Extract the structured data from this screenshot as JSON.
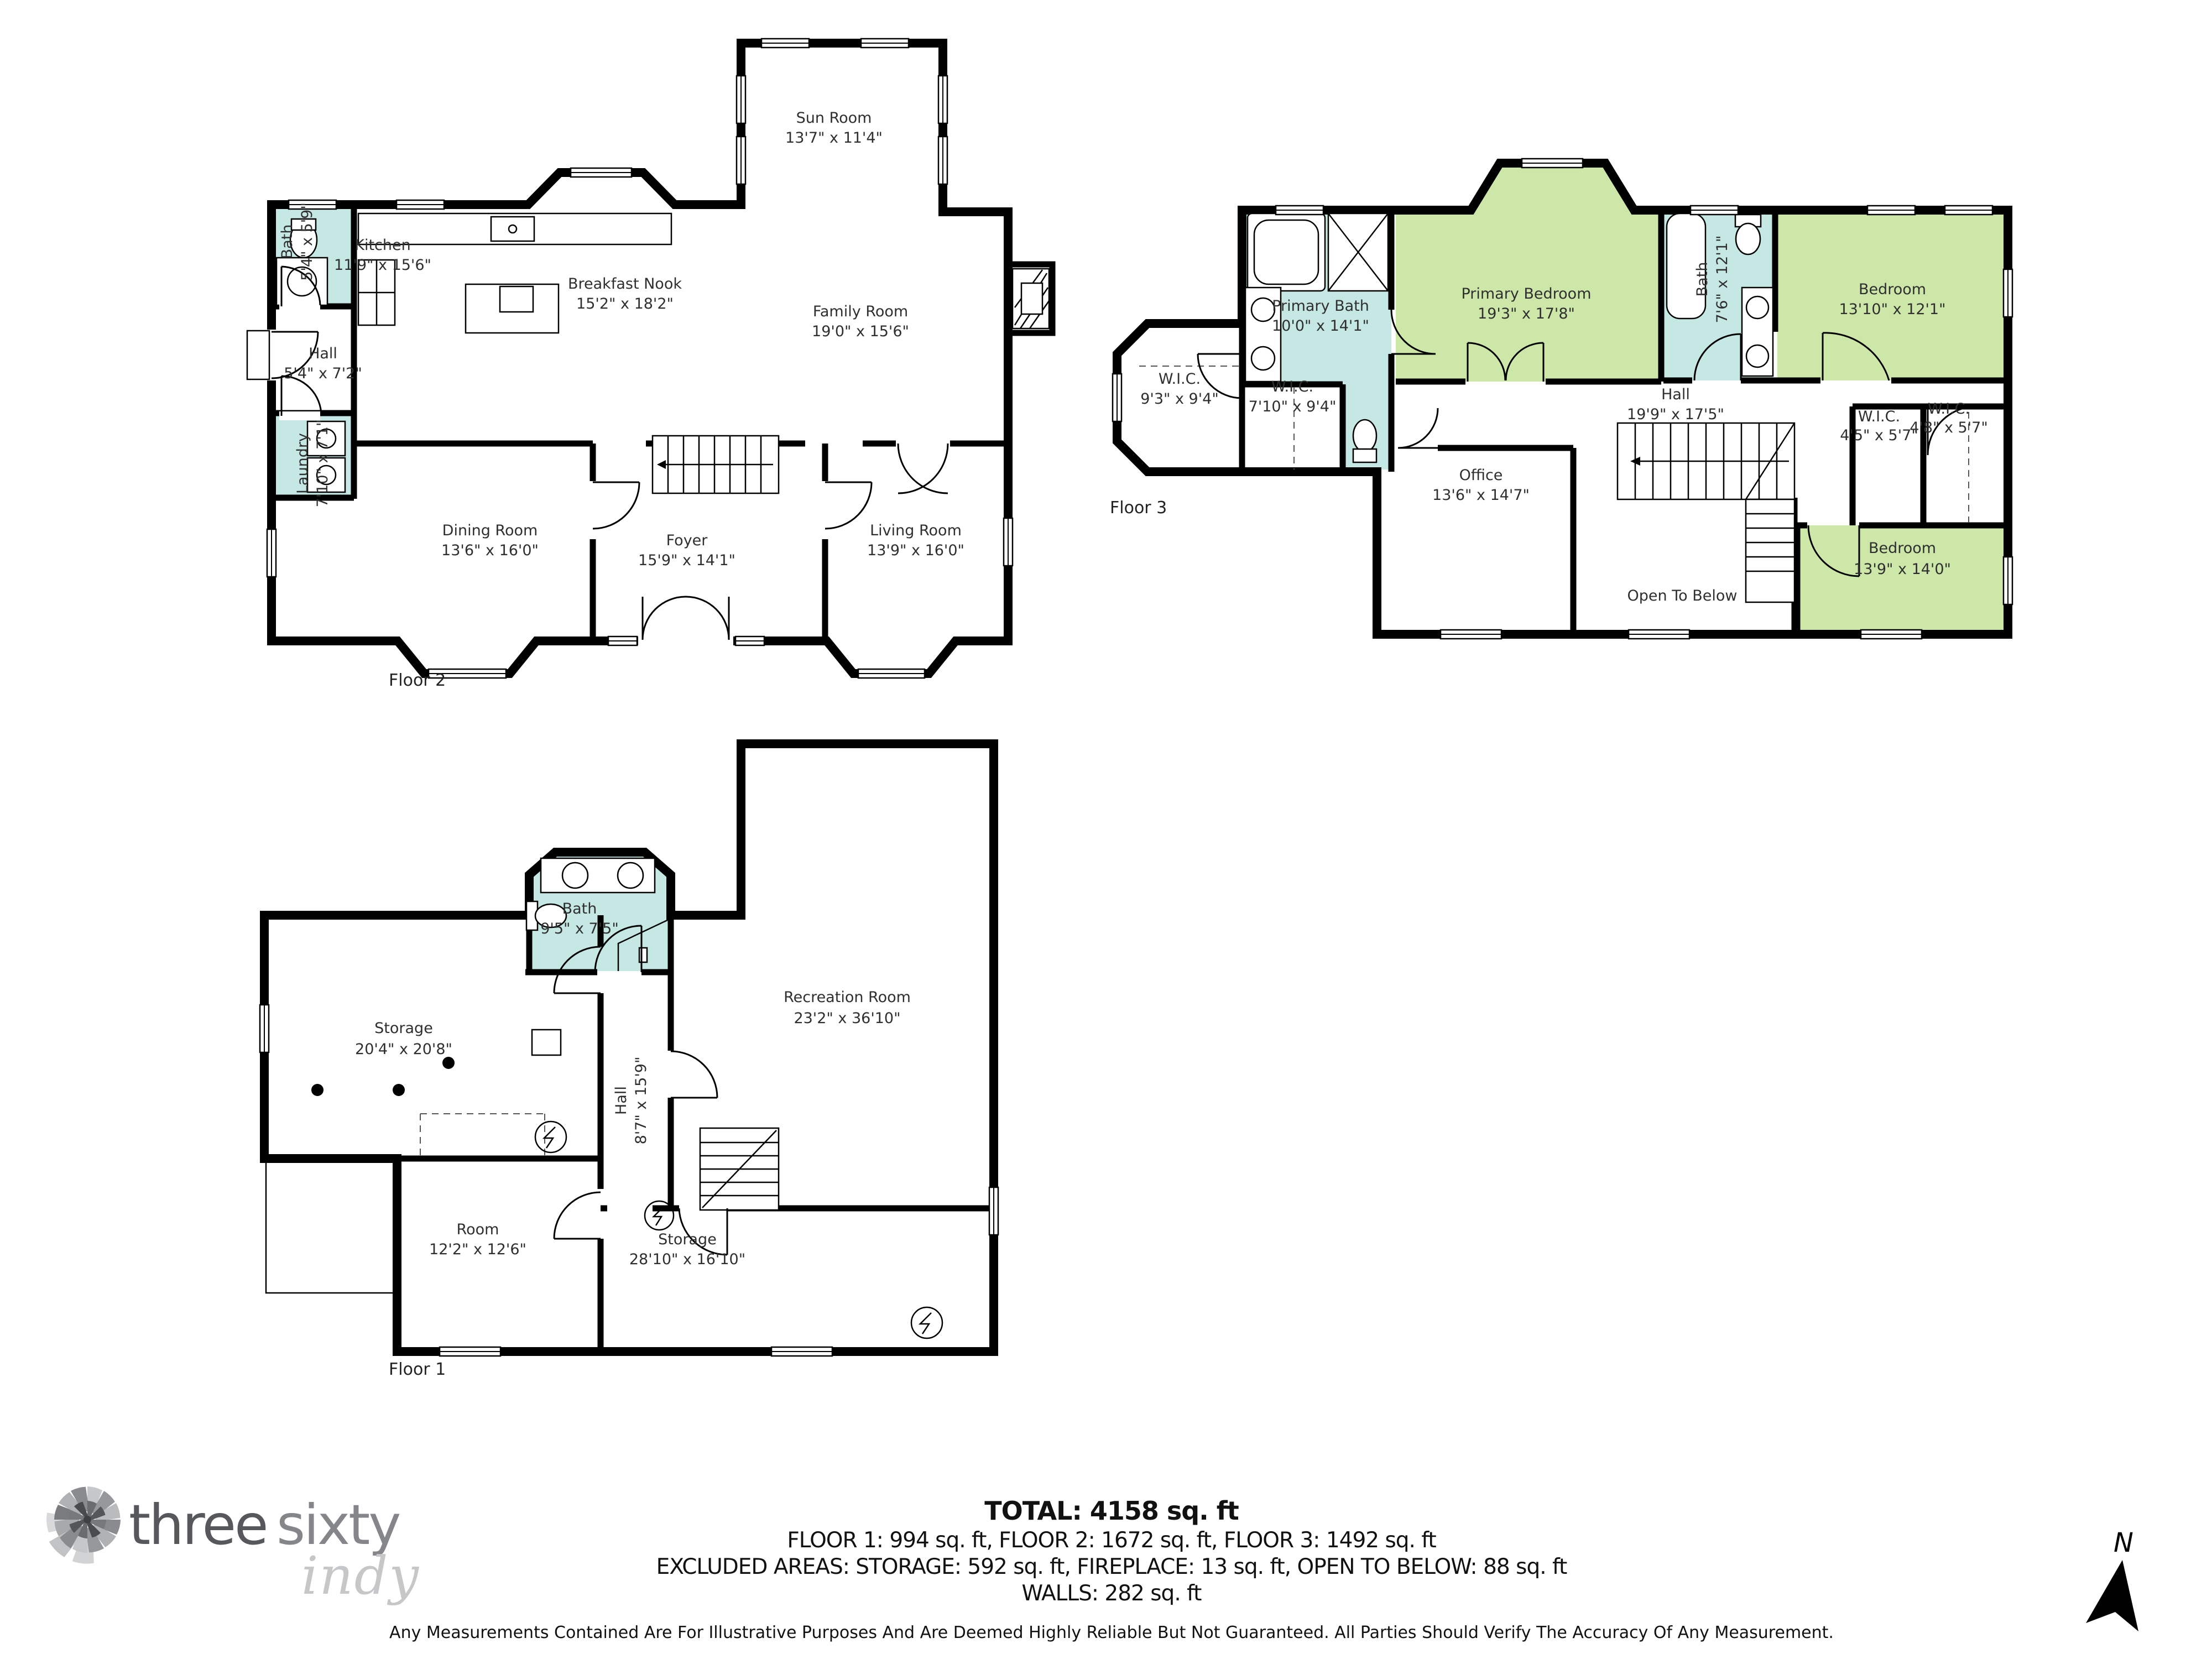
{
  "colors": {
    "bath": "#c5e8e4",
    "bedroom": "#cde7a8",
    "wall": "#000000",
    "label": "#2f2f2f",
    "logo_dark": "#57585c",
    "logo_mid": "#85868a",
    "logo_light": "#c6c7c9"
  },
  "floors": [
    {
      "label": "Floor 2",
      "rooms": [
        {
          "name": "Bath",
          "dims": "5'4\" x 5'9\""
        },
        {
          "name": "Kitchen",
          "dims": "11'9\" x 15'6\""
        },
        {
          "name": "Breakfast Nook",
          "dims": "15'2\" x 18'2\""
        },
        {
          "name": "Sun Room",
          "dims": "13'7\" x 11'4\""
        },
        {
          "name": "Family Room",
          "dims": "19'0\" x 15'6\""
        },
        {
          "name": "Hall",
          "dims": "5'4\" x 7'2\""
        },
        {
          "name": "Laundry",
          "dims": "7'10\" x 7'1\""
        },
        {
          "name": "Dining Room",
          "dims": "13'6\" x 16'0\""
        },
        {
          "name": "Foyer",
          "dims": "15'9\" x 14'1\""
        },
        {
          "name": "Living Room",
          "dims": "13'9\" x 16'0\""
        }
      ]
    },
    {
      "label": "Floor 3",
      "rooms": [
        {
          "name": "Primary Bath",
          "dims": "10'0\" x 14'1\""
        },
        {
          "name": "W.I.C.",
          "dims": "9'3\" x 9'4\""
        },
        {
          "name": "W.I.C.",
          "dims": "7'10\" x 9'4\""
        },
        {
          "name": "Primary Bedroom",
          "dims": "19'3\" x 17'8\""
        },
        {
          "name": "Bath",
          "dims": "7'6\" x 12'1\""
        },
        {
          "name": "Bedroom",
          "dims": "13'10\" x 12'1\""
        },
        {
          "name": "Hall",
          "dims": "19'9\" x 17'5\""
        },
        {
          "name": "W.I.C.",
          "dims": "4'5\" x 5'7\""
        },
        {
          "name": "W.I.C.",
          "dims": "4'8\" x 5'7\""
        },
        {
          "name": "Office",
          "dims": "13'6\" x 14'7\""
        },
        {
          "name": "Open To Below",
          "dims": ""
        },
        {
          "name": "Bedroom",
          "dims": "13'9\" x 14'0\""
        }
      ]
    },
    {
      "label": "Floor 1",
      "rooms": [
        {
          "name": "Bath",
          "dims": "9'5\" x 7'5\""
        },
        {
          "name": "Storage",
          "dims": "20'4\" x 20'8\""
        },
        {
          "name": "Hall",
          "dims": "8'7\" x 15'9\""
        },
        {
          "name": "Recreation Room",
          "dims": "23'2\" x 36'10\""
        },
        {
          "name": "Room",
          "dims": "12'2\" x 12'6\""
        },
        {
          "name": "Storage",
          "dims": "28'10\" x 16'10\""
        }
      ]
    }
  ],
  "summary": {
    "total": "TOTAL: 4158 sq. ft",
    "floors_line": "FLOOR 1: 994 sq. ft, FLOOR 2: 1672 sq. ft, FLOOR 3: 1492 sq. ft",
    "excluded_line": "EXCLUDED AREAS: STORAGE: 592 sq. ft, FIREPLACE: 13 sq. ft, OPEN TO BELOW: 88 sq. ft",
    "walls_line": "WALLS: 282 sq. ft"
  },
  "disclaimer": "Any Measurements Contained Are For Illustrative Purposes And Are Deemed Highly Reliable But Not Guaranteed. All Parties Should Verify The Accuracy Of Any Measurement.",
  "logo": {
    "part1": "three",
    "part2": "sixty",
    "part3": "indy"
  },
  "compass": {
    "label": "N"
  }
}
